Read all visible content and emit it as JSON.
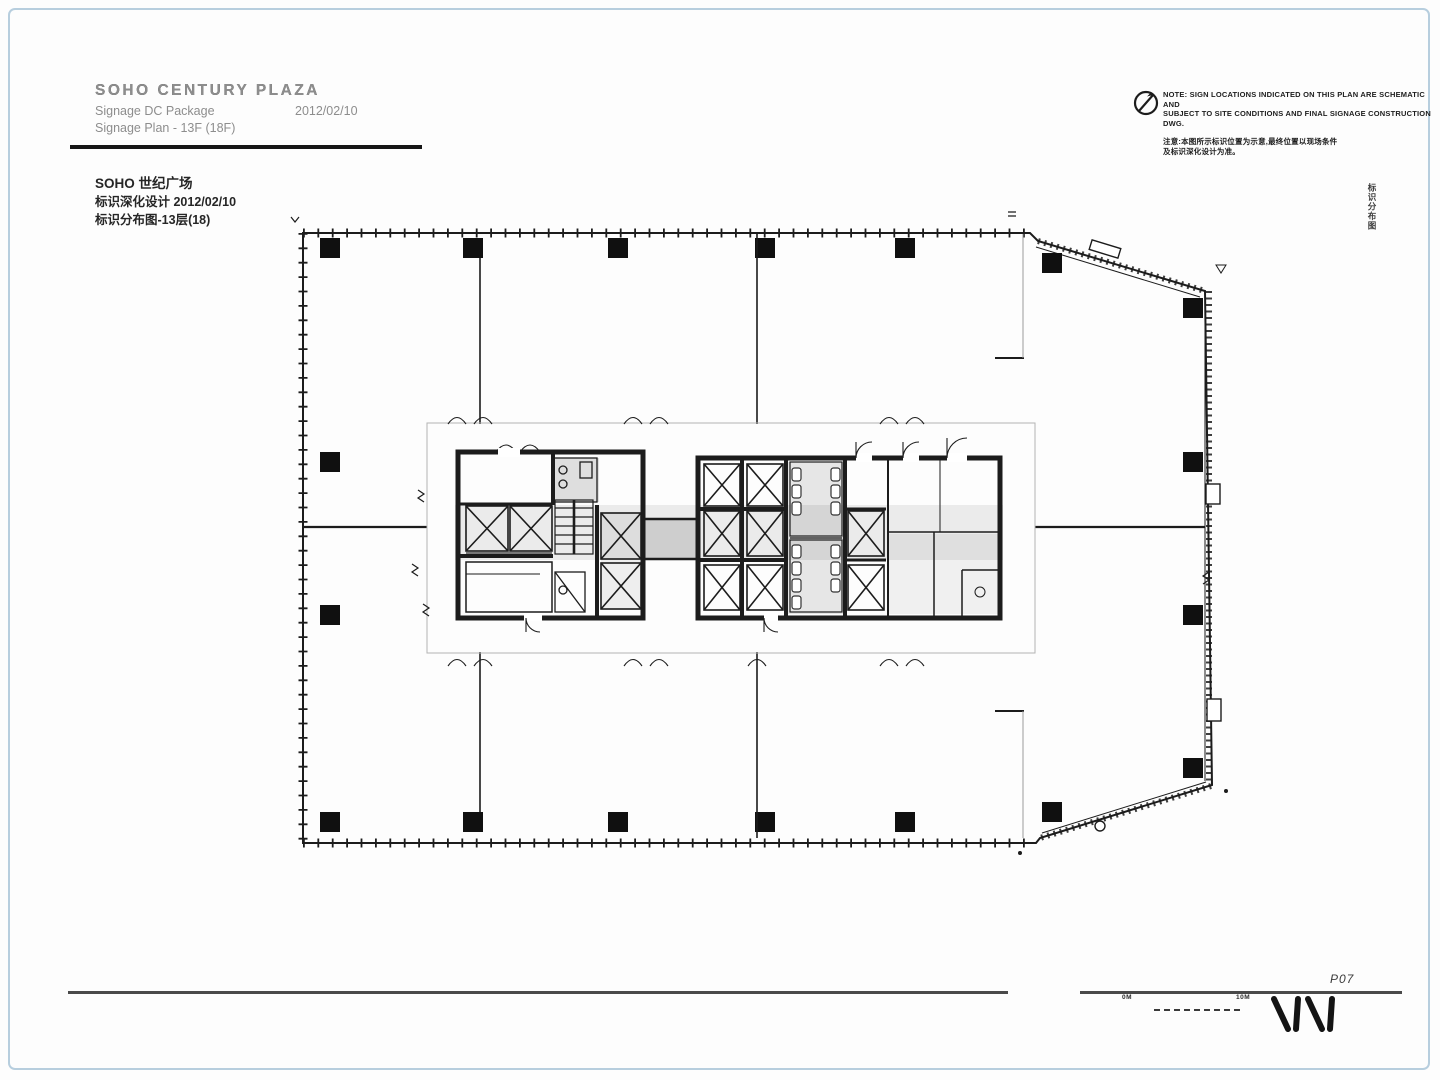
{
  "colors": {
    "frame_border": "#b7cede",
    "ink": "#1c1c1c",
    "muted_gray": "#8d8d8d"
  },
  "title_block": {
    "en_title": "SOHO CENTURY PLAZA",
    "en_package_label": "Signage DC Package",
    "en_package_date": "2012/02/10",
    "en_plan_label": "Signage Plan - 13F (18F)",
    "cn_title": "SOHO 世纪广场",
    "cn_package": "标识深化设计 2012/02/10",
    "cn_plan": "标识分布图-13层(18)"
  },
  "north_note": {
    "icon": "north-arrow-icon",
    "lines": [
      "NOTE: SIGN LOCATIONS INDICATED ON THIS PLAN ARE SCHEMATIC AND",
      "SUBJECT TO SITE CONDITIONS AND FINAL SIGNAGE CONSTRUCTION",
      "DWG.",
      "注意:本图所示标识位置为示意,最终位置以现场条件",
      "及标识深化设计为准。"
    ]
  },
  "side_label": "标识分布图",
  "footer": {
    "page_number": "P07",
    "scale_left": "0M",
    "scale_right": "10M",
    "logo": "AIM"
  }
}
